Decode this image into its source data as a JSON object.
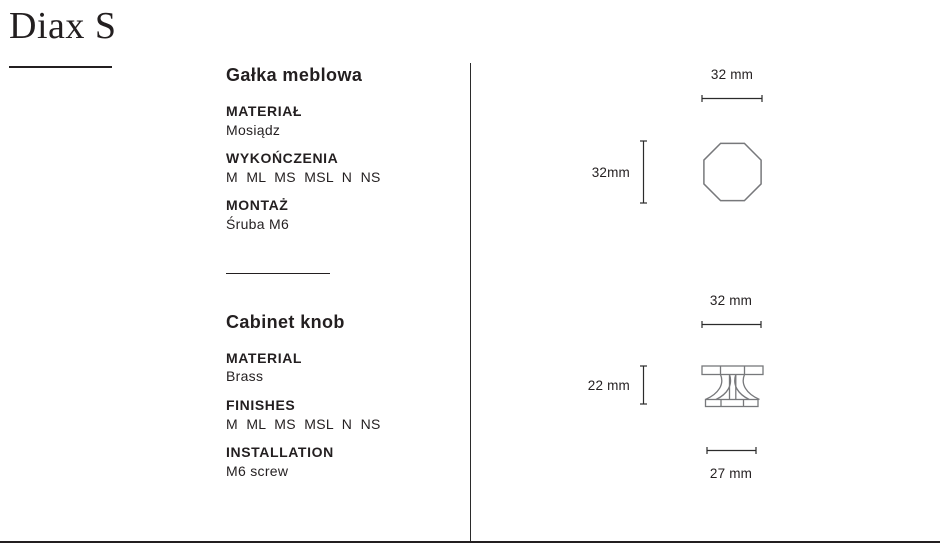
{
  "page": {
    "title": "Diax S"
  },
  "specs": {
    "pl": {
      "section_title": "Gałka meblowa",
      "rows": [
        {
          "label": "MATERIAŁ",
          "value": "Mosiądz"
        },
        {
          "label": "WYKOŃCZENIA",
          "value": "M  ML  MS  MSL  N  NS"
        },
        {
          "label": "MONTAŻ",
          "value": "Śruba M6"
        }
      ]
    },
    "en": {
      "section_title": "Cabinet knob",
      "rows": [
        {
          "label": "MATERIAL",
          "value": "Brass"
        },
        {
          "label": "FINISHES",
          "value": "M  ML  MS  MSL  N  NS"
        },
        {
          "label": "INSTALLATION",
          "value": "M6 screw"
        }
      ]
    }
  },
  "drawings": {
    "top_view": {
      "shape": "octagon",
      "width_label": "32 mm",
      "height_label": "32mm"
    },
    "side_view": {
      "shape": "knob-profile",
      "top_width_label": "32 mm",
      "height_label": "22 mm",
      "base_width_label": "27 mm"
    }
  },
  "colors": {
    "text": "#231f20",
    "drawing_stroke": "#77787b",
    "dimension_line": "#2b2b2b",
    "background": "#ffffff"
  }
}
